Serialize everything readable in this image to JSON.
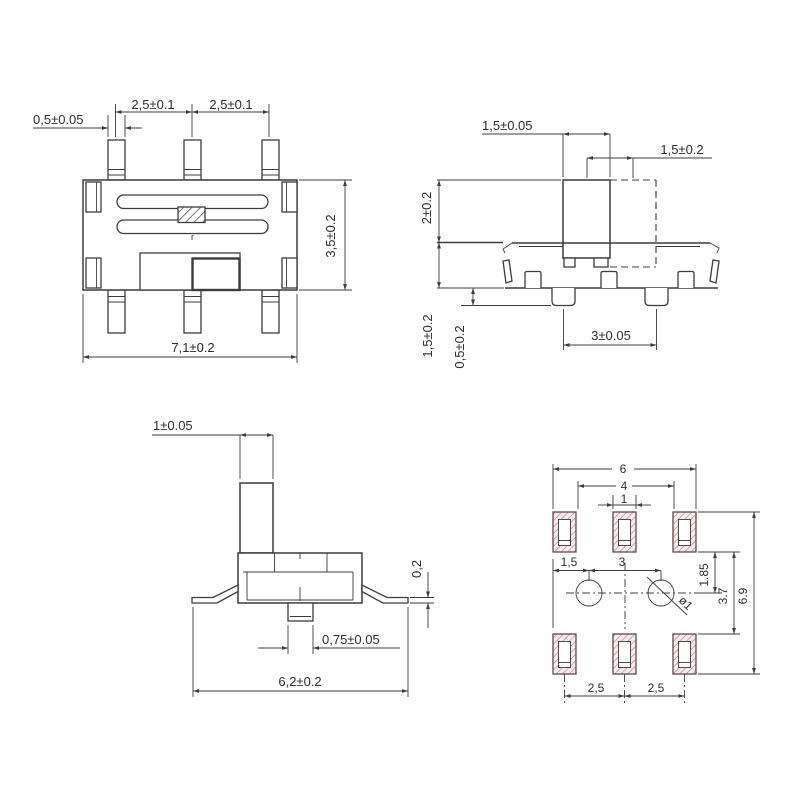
{
  "drawing_title": "slide-switch-dimension-drawing",
  "colors": {
    "line": "#3c3c3c",
    "text": "#2d2d2d",
    "pad_hatch": "#c4737f",
    "pad_fill": "#f7ecee",
    "background": "#ffffff"
  },
  "views": {
    "top": {
      "name": "top-view",
      "mark": "r",
      "dims": {
        "pin_width": "0,5±0.05",
        "pitch_left": "2,5±0.1",
        "pitch_right": "2,5±0.1",
        "body_depth": "3,5±0.2",
        "body_width": "7,1±0.2"
      }
    },
    "side": {
      "name": "side-view",
      "dims": {
        "knob_width": "1,5±0.05",
        "travel": "1,5±0.2",
        "knob_height": "2±0.2",
        "body_height": "1,5±0.2",
        "post_height": "0,5±0.2",
        "post_pitch": "3±0.05"
      }
    },
    "end": {
      "name": "end-view",
      "dims": {
        "knob_thickness": "1±0.05",
        "lead_thickness": "0,2",
        "post_width": "0,75±0.05",
        "overall_width": "6,2±0.2"
      }
    },
    "pcb": {
      "name": "pcb-land-pattern",
      "dims": {
        "outer_span": "6",
        "inner_span": "4",
        "pad_width": "1",
        "hole_offset": "1,5",
        "hole_pitch": "3",
        "pad_to_hole": "1.85",
        "row_gap": "3.7",
        "overall_height": "6.9",
        "pitch_left": "2,5",
        "pitch_right": "2,5",
        "hole_dia": "ø1"
      }
    }
  }
}
